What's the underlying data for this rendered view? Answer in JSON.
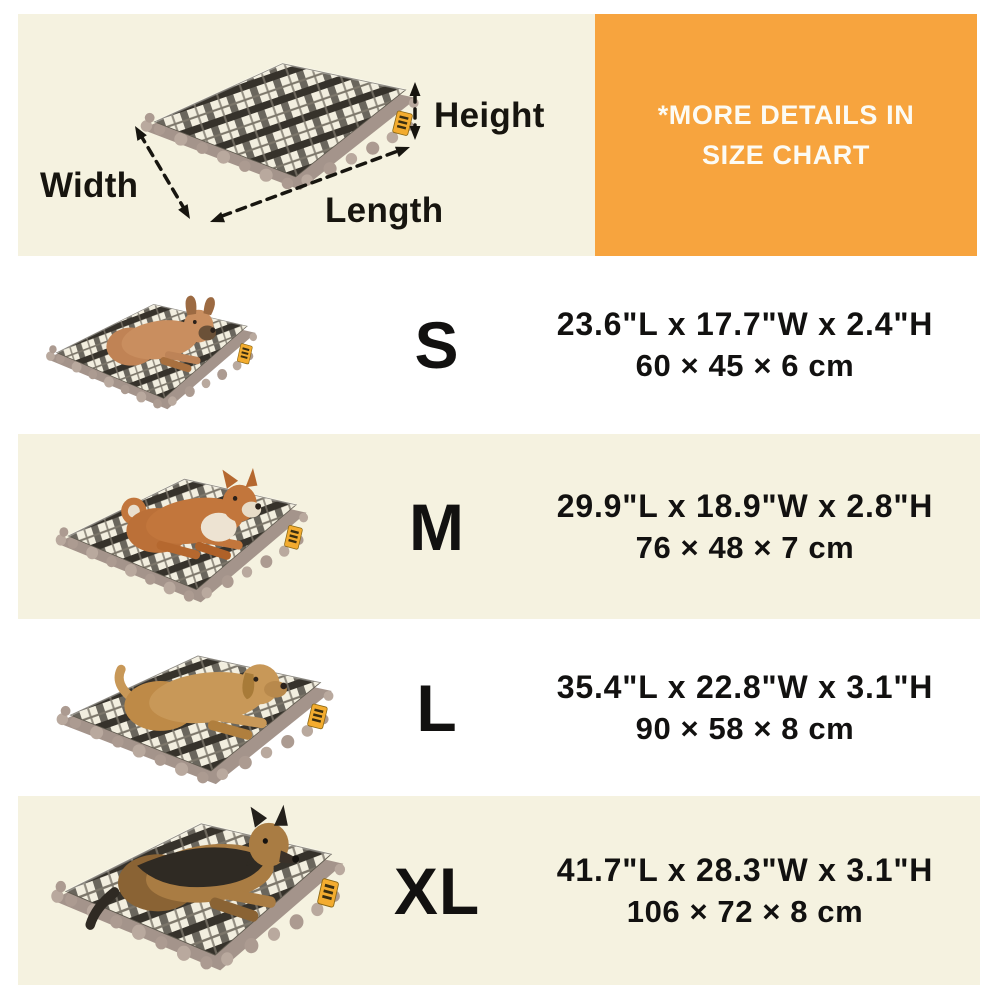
{
  "colors": {
    "background": "#FFFFFF",
    "panel_cream": "#F5F2E0",
    "banner_orange": "#F7A43E",
    "text_black": "#17150F",
    "banner_text": "#FCFBF4",
    "tag_yellow": "#F3AC2F"
  },
  "diagram": {
    "width_label": "Width",
    "height_label": "Height",
    "length_label": "Length",
    "image": "plaid-dog-bed-with-dimension-arrows"
  },
  "banner": {
    "line1": "*MORE DETAILS IN",
    "line2": "SIZE CHART"
  },
  "rows": [
    {
      "size": "S",
      "imperial": "23.6\"L x 17.7\"W x 2.4\"H",
      "metric": "60 × 45 × 6 cm",
      "dog": "french-bulldog"
    },
    {
      "size": "M",
      "imperial": "29.9\"L x 18.9\"W x 2.8\"H",
      "metric": "76 × 48 × 7 cm",
      "dog": "shiba-inu"
    },
    {
      "size": "L",
      "imperial": "35.4\"L x 22.8\"W x 3.1\"H",
      "metric": "90 × 58 × 8 cm",
      "dog": "golden-retriever"
    },
    {
      "size": "XL",
      "imperial": "41.7\"L x 28.3\"W x 3.1\"H",
      "metric": "106 × 72 × 8 cm",
      "dog": "german-shepherd"
    }
  ]
}
